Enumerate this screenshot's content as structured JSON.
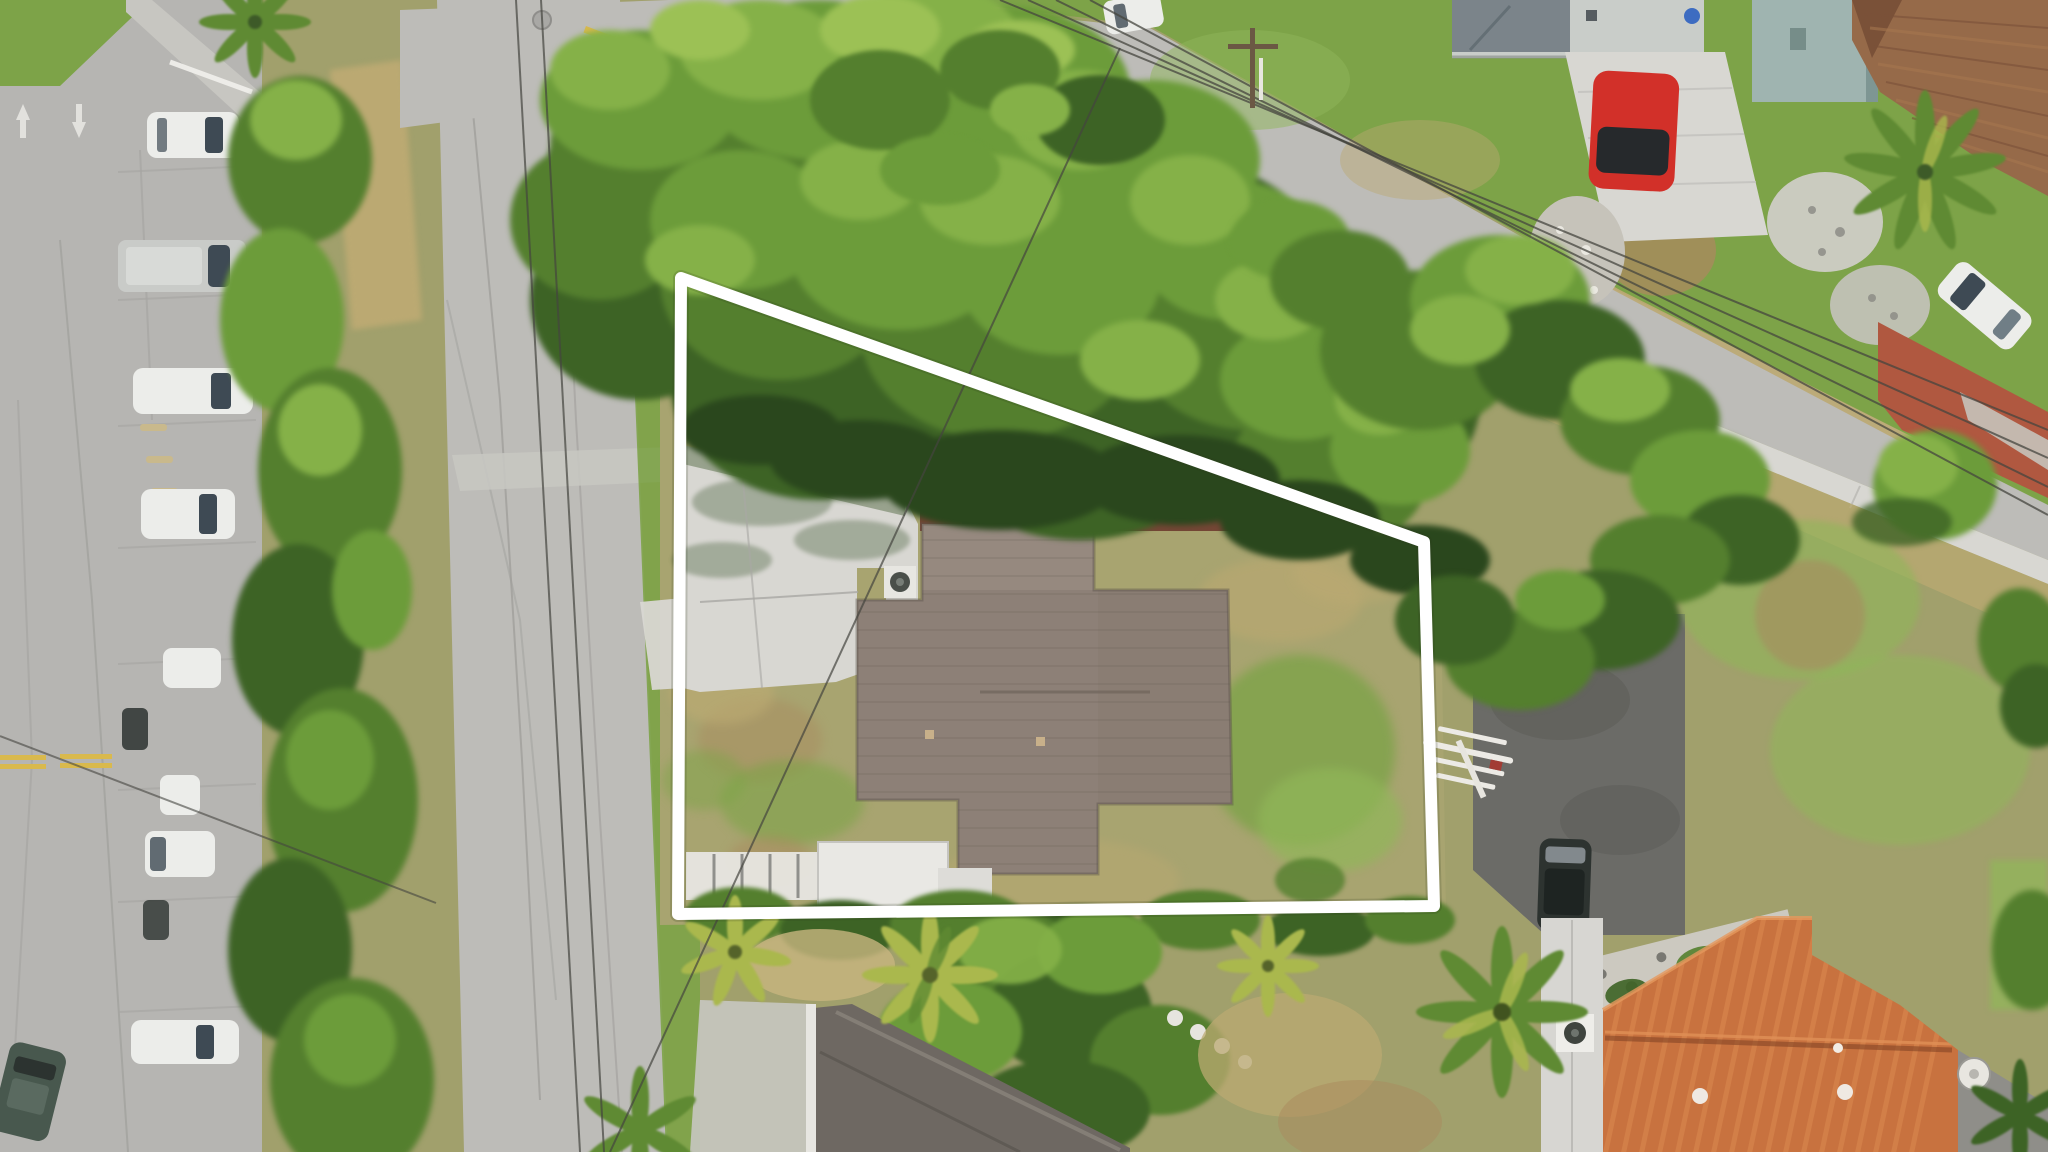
{
  "title": "Aerial drone photo of a residential lot outlined with a white property boundary",
  "scene": {
    "description": "Top-down drone photograph: subject lot with gray shingle-roof house, concrete driveway, patchy lawns and large oak canopy, outlined by a white boundary polygon. Streets on the left and top, diagonal parking with cars on far left, neighboring houses, palms, an orange barrel-tile roof at bottom right, black SUV on rear asphalt pad, power lines crossing.",
    "boundary": {
      "points": "681,278 1424,542 1434,906 678,914",
      "color": "#ffffff",
      "stroke_width": 12
    },
    "palette": {
      "base": "#a1a06c",
      "asphalt_lot": "#b6b5b2",
      "asphalt_road": "#bdbcb8",
      "asphalt_dark": "#6b6b67",
      "concrete": "#d8d7d2",
      "concrete_dim": "#c7c6c1",
      "crack": "#a09f9b",
      "grass_green": "#7da348",
      "grass_bright": "#90b659",
      "grass_dry": "#bba972",
      "grass_pale": "#a8a470",
      "dirt": "#a9895e",
      "sand": "#c8b580",
      "mulch_red": "#6e3c2f",
      "canopy_sun": "#9cc155",
      "canopy_light": "#85b148",
      "canopy_mid": "#6c9c3a",
      "canopy_deep": "#547f2e",
      "canopy_dark": "#3d6325",
      "canopy_shadow": "#2a471d",
      "palm_yellow": "#aab84d",
      "palm_green": "#5f8a33",
      "roof_shingle": "#8d8077",
      "roof_shingle_light": "#9c9086",
      "roof_shingle_dark": "#6f645b",
      "roof_light": "#c9cdc9",
      "roof_gray_dark": "#7b848a",
      "roof_teal": "#9fb4b0",
      "roof_brown": "#966a49",
      "roof_brown_dark": "#7a5138",
      "roof_orange": "#c8723f",
      "roof_orange_light": "#dd8c52",
      "roof_orange_dark": "#a55a30",
      "tile_red": "#b05840",
      "white_struct": "#e7e6e1",
      "gravel": "#c6c3ba",
      "stone_wall": "#ccc9c0",
      "car_white": "#ecedea",
      "car_glass": "#3e4a54",
      "car_red": "#d23029",
      "car_dark": "#2d3330",
      "car_green": "#48584e",
      "car_silver": "#c9cbc8",
      "line_yellow": "#d9b94d",
      "road_marking": "#eae9e5",
      "wire": "#45453f",
      "pole_brown": "#6b5844",
      "barrel_blue": "#3d6cc1",
      "boundary": "#ffffff"
    },
    "features": [
      "property-boundary",
      "subject-house-roof",
      "subject-driveway",
      "oak-canopy",
      "perimeter-hedge",
      "street-left",
      "street-top",
      "parking-lot",
      "parked-cars-row",
      "red-sports-car",
      "black-suv",
      "neighbor-house-north",
      "neighbor-house-teal",
      "neighbor-roof-brown",
      "neighbor-roof-orange",
      "rear-building-roof",
      "palm-trees",
      "power-lines",
      "utility-pole",
      "sidewalk",
      "brick-paver-apron",
      "gravel-landscaping",
      "stone-wall",
      "debris-pile",
      "ac-unit",
      "patio-slab",
      "white-fence",
      "stepping-stones",
      "yellow-center-lines",
      "manhole-cover",
      "trash-bin",
      "blue-barrel",
      "satellite-dish"
    ]
  }
}
